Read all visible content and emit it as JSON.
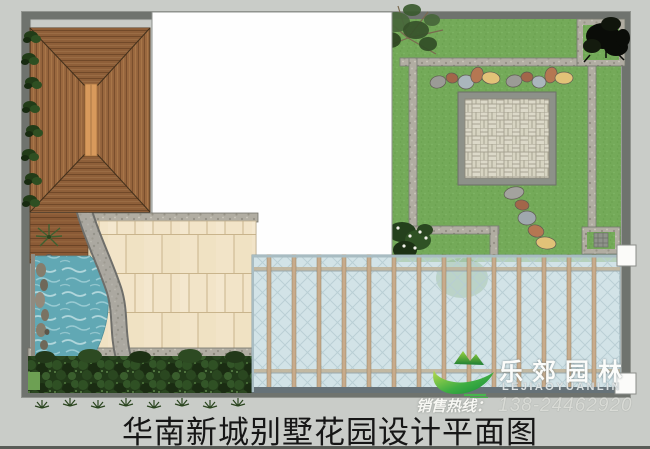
{
  "title": "华南新城别墅花园设计平面图",
  "branding": {
    "logo_cn": "乐郊园林",
    "logo_en": "LEJIAOYUANLIN",
    "hotline_label": "销售热线：",
    "hotline_number": "138-24462920"
  },
  "colors": {
    "background": "#c9ccc8",
    "lawn_green": "#74aa59",
    "pool_water": "#61a8b4",
    "pavilion_wood": "#9a683f",
    "paving_cream": "#f2e4c8",
    "canopy_glass": "#d2e3e7",
    "boundary_wall": "#6f736e",
    "logo_green": "#3fae43",
    "title_color": "#161616"
  }
}
